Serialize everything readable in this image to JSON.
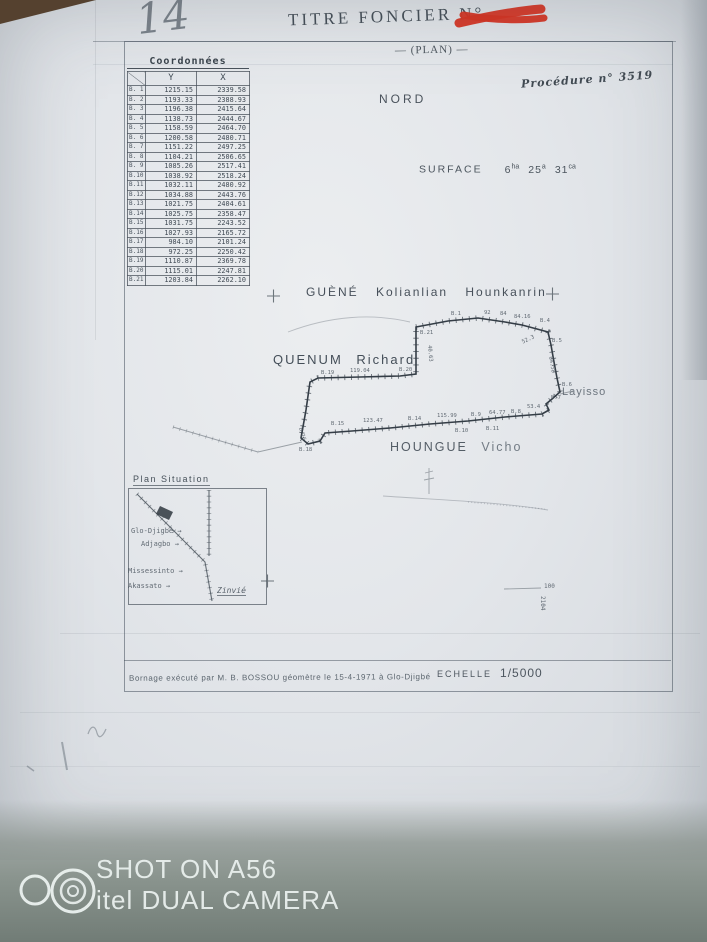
{
  "header": {
    "handwritten_number": "14",
    "title": "TITRE FONCIER N°",
    "subtitle": "— (PLAN) —",
    "procedure": "Procédure n° 3519"
  },
  "coordinates_table": {
    "title": "Coordonnées",
    "columns": [
      "Y",
      "X"
    ],
    "rows": [
      {
        "id": "B. 1",
        "y": "1215.15",
        "x": "2339.58"
      },
      {
        "id": "B. 2",
        "y": "1193.33",
        "x": "2388.93"
      },
      {
        "id": "B. 3",
        "y": "1196.38",
        "x": "2415.64"
      },
      {
        "id": "B. 4",
        "y": "1138.73",
        "x": "2444.67"
      },
      {
        "id": "B. 5",
        "y": "1158.59",
        "x": "2464.70"
      },
      {
        "id": "B. 6",
        "y": "1200.58",
        "x": "2480.71"
      },
      {
        "id": "B. 7",
        "y": "1151.22",
        "x": "2497.25"
      },
      {
        "id": "B. 8",
        "y": "1104.21",
        "x": "2506.65"
      },
      {
        "id": "B. 9",
        "y": "1085.26",
        "x": "2517.41"
      },
      {
        "id": "B.10",
        "y": "1038.92",
        "x": "2518.24"
      },
      {
        "id": "B.11",
        "y": "1032.11",
        "x": "2480.92"
      },
      {
        "id": "B.12",
        "y": "1034.88",
        "x": "2443.76"
      },
      {
        "id": "B.13",
        "y": "1021.75",
        "x": "2404.61"
      },
      {
        "id": "B.14",
        "y": "1025.75",
        "x": "2358.47"
      },
      {
        "id": "B.15",
        "y": "1031.75",
        "x": "2243.52"
      },
      {
        "id": "B.16",
        "y": "1027.93",
        "x": "2165.72"
      },
      {
        "id": "B.17",
        "y": "984.10",
        "x": "2101.24"
      },
      {
        "id": "B.18",
        "y": "972.25",
        "x": "2250.42"
      },
      {
        "id": "B.19",
        "y": "1110.87",
        "x": "2369.78"
      },
      {
        "id": "B.20",
        "y": "1115.01",
        "x": "2247.81"
      },
      {
        "id": "B.21",
        "y": "1203.84",
        "x": "2262.10"
      }
    ]
  },
  "plan": {
    "north": "NORD",
    "surface_label": "SURFACE",
    "surface": {
      "v1": "6",
      "u1": "ha",
      "v2": "25",
      "u2": "a",
      "v3": "31",
      "u3": "ca"
    },
    "neighbor_north": "GUÈNÉ Kolianlian Hounkanrin",
    "neighbor_west": "QUENUM Richard",
    "neighbor_south_1": "HOUNGUE",
    "neighbor_south_2": "Vicho",
    "locality_east": "Layisso",
    "annotations": [
      {
        "t": "B.1",
        "x": 451,
        "y": 311
      },
      {
        "t": "92",
        "x": 484,
        "y": 310
      },
      {
        "t": "84",
        "x": 500,
        "y": 311
      },
      {
        "t": "84.16",
        "x": 514,
        "y": 314
      },
      {
        "t": "B.4",
        "x": 540,
        "y": 318
      },
      {
        "t": "52.3",
        "x": 521,
        "y": 340,
        "r": -25
      },
      {
        "t": "B.5",
        "x": 552,
        "y": 338
      },
      {
        "t": "64.58",
        "x": 553,
        "y": 356,
        "r": 80
      },
      {
        "t": "B.6",
        "x": 562,
        "y": 382
      },
      {
        "t": "B.7",
        "x": 551,
        "y": 395
      },
      {
        "t": "53.4",
        "x": 527,
        "y": 404
      },
      {
        "t": "B.8",
        "x": 511,
        "y": 409
      },
      {
        "t": "64.77",
        "x": 489,
        "y": 410
      },
      {
        "t": "B.9",
        "x": 471,
        "y": 412
      },
      {
        "t": "115.99",
        "x": 437,
        "y": 413
      },
      {
        "t": "B.14",
        "x": 408,
        "y": 416
      },
      {
        "t": "123.47",
        "x": 363,
        "y": 418
      },
      {
        "t": "B.15",
        "x": 331,
        "y": 421
      },
      {
        "t": "B.10",
        "x": 455,
        "y": 428
      },
      {
        "t": "B.11",
        "x": 486,
        "y": 426
      },
      {
        "t": "B.16",
        "x": 303,
        "y": 427,
        "r": 75
      },
      {
        "t": "B.18",
        "x": 299,
        "y": 447
      },
      {
        "t": "119.04",
        "x": 350,
        "y": 368
      },
      {
        "t": "B.19",
        "x": 321,
        "y": 370
      },
      {
        "t": "B.20",
        "x": 399,
        "y": 367
      },
      {
        "t": "B.21",
        "x": 420,
        "y": 330
      },
      {
        "t": "40.63",
        "x": 432,
        "y": 345,
        "r": 85
      },
      {
        "t": "100",
        "x": 544,
        "y": 583,
        "s": 6
      },
      {
        "t": "2104",
        "x": 546,
        "y": 596,
        "r": 90,
        "s": 6
      }
    ]
  },
  "inset": {
    "title": "Plan Situation",
    "road_labels": [
      {
        "t": "Glo-Djigbé →",
        "x": 131,
        "y": 527,
        "s": 7
      },
      {
        "t": "Adjagbo →",
        "x": 141,
        "y": 540,
        "s": 7
      },
      {
        "t": "Missessinto →",
        "x": 128,
        "y": 567,
        "s": 7
      },
      {
        "t": "Akassato →",
        "x": 128,
        "y": 582,
        "s": 7
      },
      {
        "t": "Zinvié",
        "x": 217,
        "y": 586,
        "s": 8,
        "c": "ann-underline"
      }
    ]
  },
  "footer": {
    "scale_label": "ECHELLE",
    "scale_value": "1/5000",
    "bornage": "Bornage exécuté par M. B. BOSSOU géomètre le 15-4-1971 à Glo-Djigbé"
  },
  "watermark": {
    "line1": "SHOT ON A56",
    "line2": "itel DUAL CAMERA"
  },
  "colors": {
    "ink": "#3b454f",
    "accent_red": "#d8301f",
    "paper": "#e3e6ea",
    "table_wood": "#55412f",
    "watermark_text": "#e7edeb"
  }
}
